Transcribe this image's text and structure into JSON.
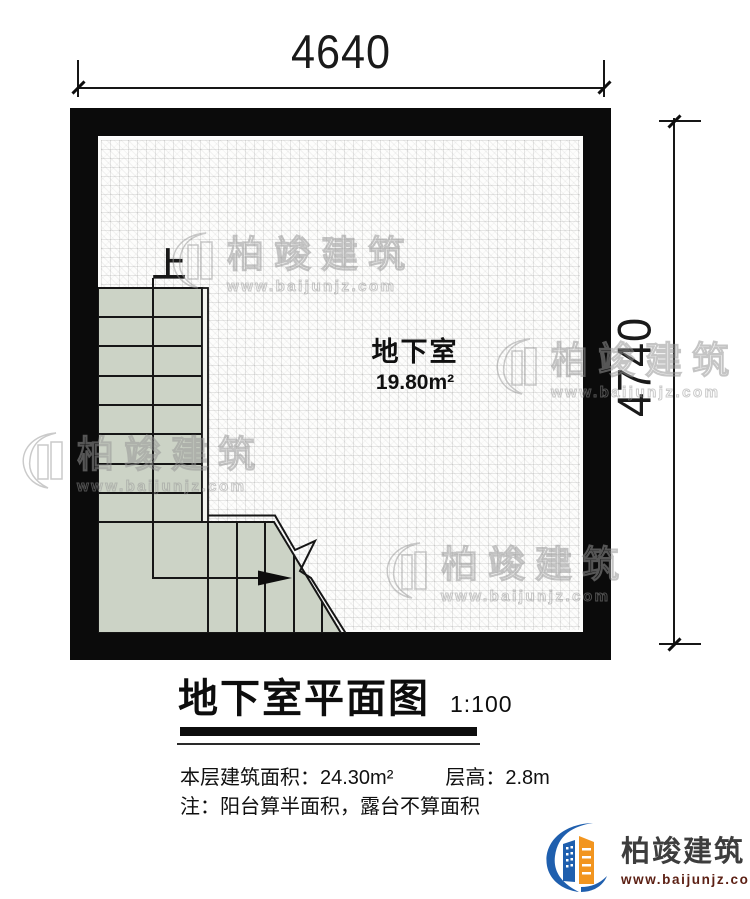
{
  "dimensions": {
    "top": "4640",
    "right": "4740"
  },
  "plan": {
    "room_name": "地下室",
    "room_area": "19.80m²",
    "stair_direction_label": "上",
    "wall_color": "#0b0b0b",
    "stair_fill": "#ccd3c6"
  },
  "title_block": {
    "title": "地下室平面图",
    "scale": "1:100"
  },
  "info": {
    "floor_area": "本层建筑面积：24.30m²",
    "floor_height": "层高：2.8m",
    "note": "注：阳台算半面积，露台不算面积"
  },
  "branding": {
    "company": "柏竣建筑",
    "website": "www.baijunjz.com",
    "brand_blue": "#1f5fae",
    "brand_orange": "#f2951f",
    "url_color": "#5c2014"
  },
  "watermark": {
    "company": "柏竣建筑",
    "website": "www.baijunjz.com"
  }
}
